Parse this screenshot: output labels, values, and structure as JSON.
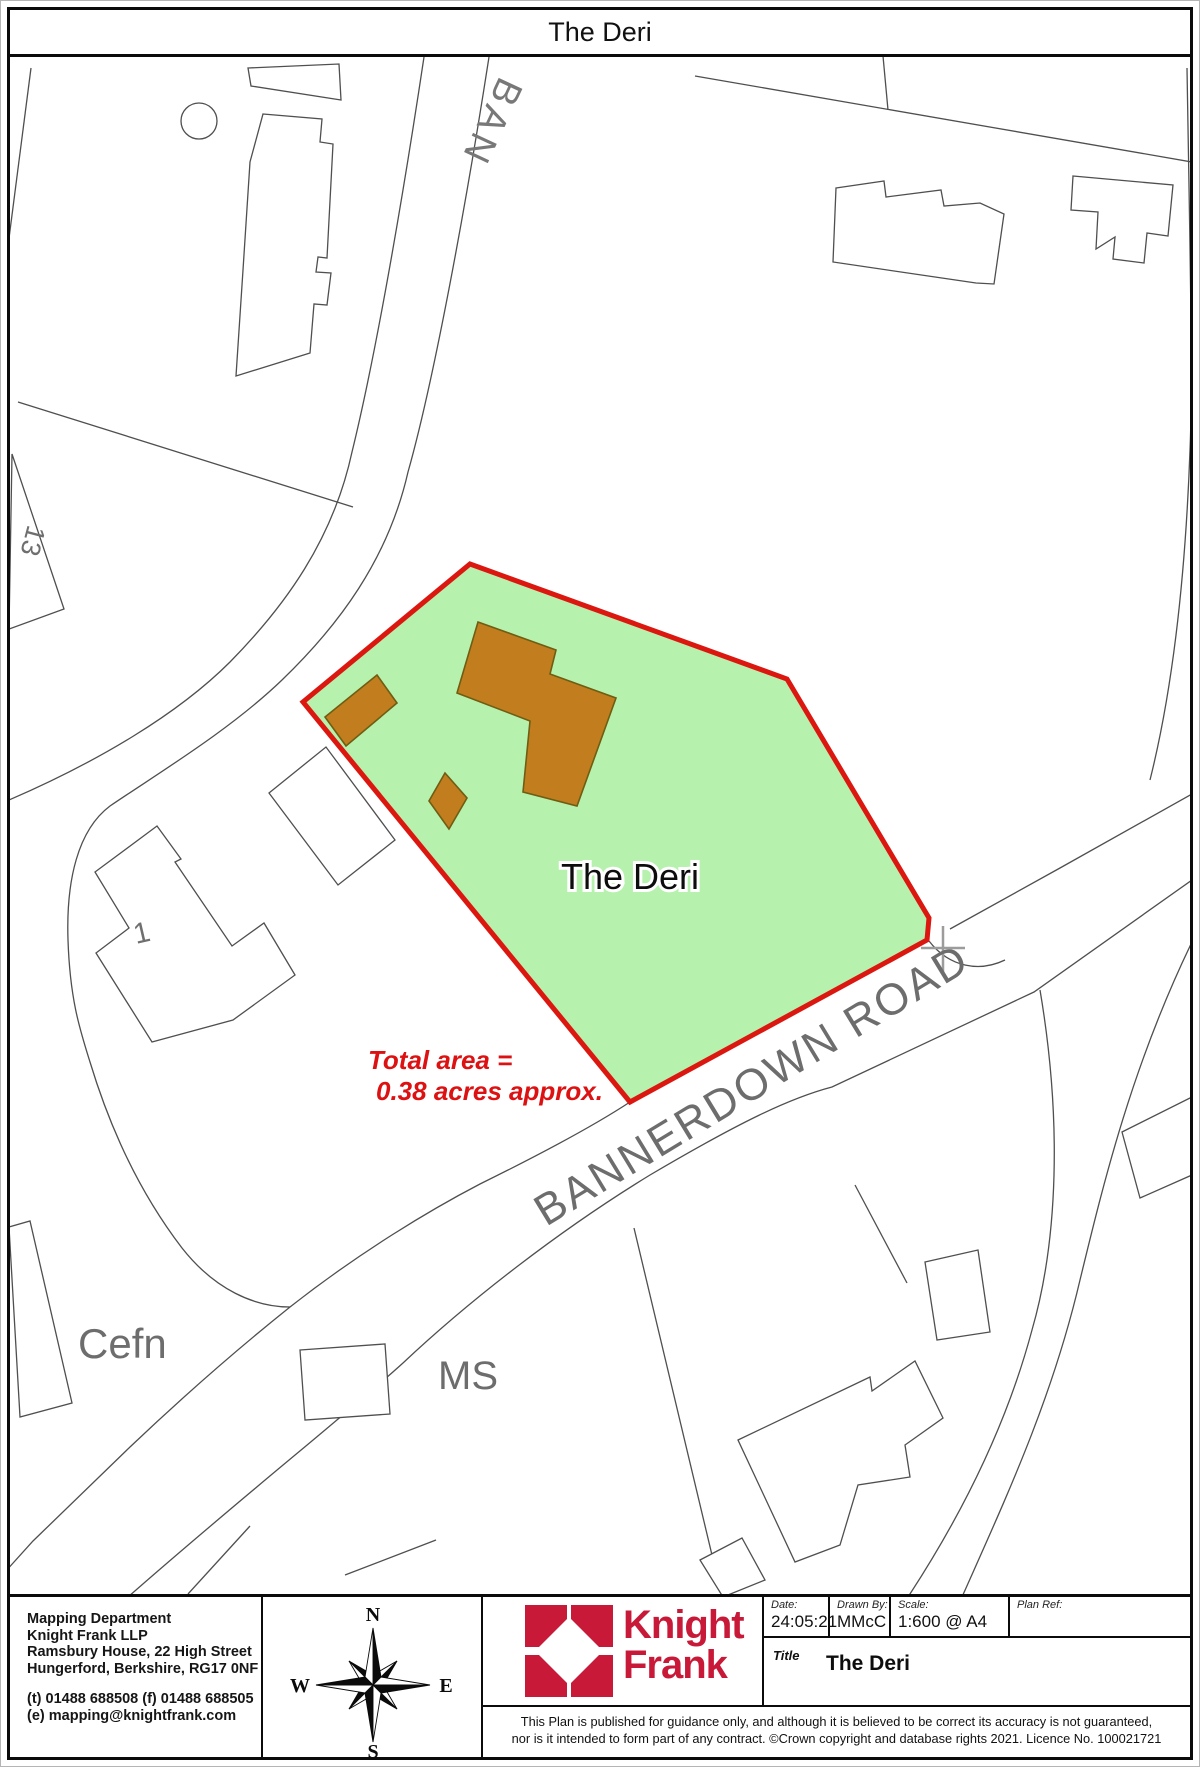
{
  "page": {
    "title": "The Deri"
  },
  "map": {
    "labels": {
      "road_top_fragment": "BAN",
      "plot13": "13",
      "plot1": "1",
      "property_name": "The Deri",
      "area_line1": "Total area =",
      "area_line2": "0.38 acres approx.",
      "road_main": "BANNERDOWN ROAD",
      "cefn": "Cefn",
      "ms": "MS"
    },
    "colors": {
      "property_fill": "#b6f2ae",
      "boundary_red": "#dc1710",
      "building_brown": "#c17d1e",
      "building_outline": "#6f5d12",
      "map_line": "#4f4f4f",
      "label_gray": "#6d6d6d",
      "area_text_red": "#dd1111"
    }
  },
  "footer": {
    "address": [
      "Mapping Department",
      "Knight Frank LLP",
      "Ramsbury House, 22 High Street",
      "Hungerford, Berkshire, RG17 0NF"
    ],
    "contact": [
      "(t) 01488 688508 (f) 01488 688505",
      "(e) mapping@knightfrank.com"
    ],
    "compass": {
      "n": "N",
      "s": "S",
      "e": "E",
      "w": "W"
    },
    "logo": {
      "line1": "Knight",
      "line2": "Frank",
      "color": "#c81a38"
    },
    "fields": [
      {
        "label": "Date:",
        "value": "24:05:21"
      },
      {
        "label": "Drawn By:",
        "value": "MMcC"
      },
      {
        "label": "Scale:",
        "value": "1:600 @ A4"
      },
      {
        "label": "Plan Ref:",
        "value": ""
      }
    ],
    "title_field": {
      "label": "Title",
      "value": "The Deri"
    },
    "disclaimer_line1": "This Plan is published for guidance only, and although it is believed to be correct its accuracy is not guaranteed,",
    "disclaimer_line2": "nor is it intended to form part of any contract. ©Crown copyright and database rights 2021. Licence No. 100021721"
  }
}
